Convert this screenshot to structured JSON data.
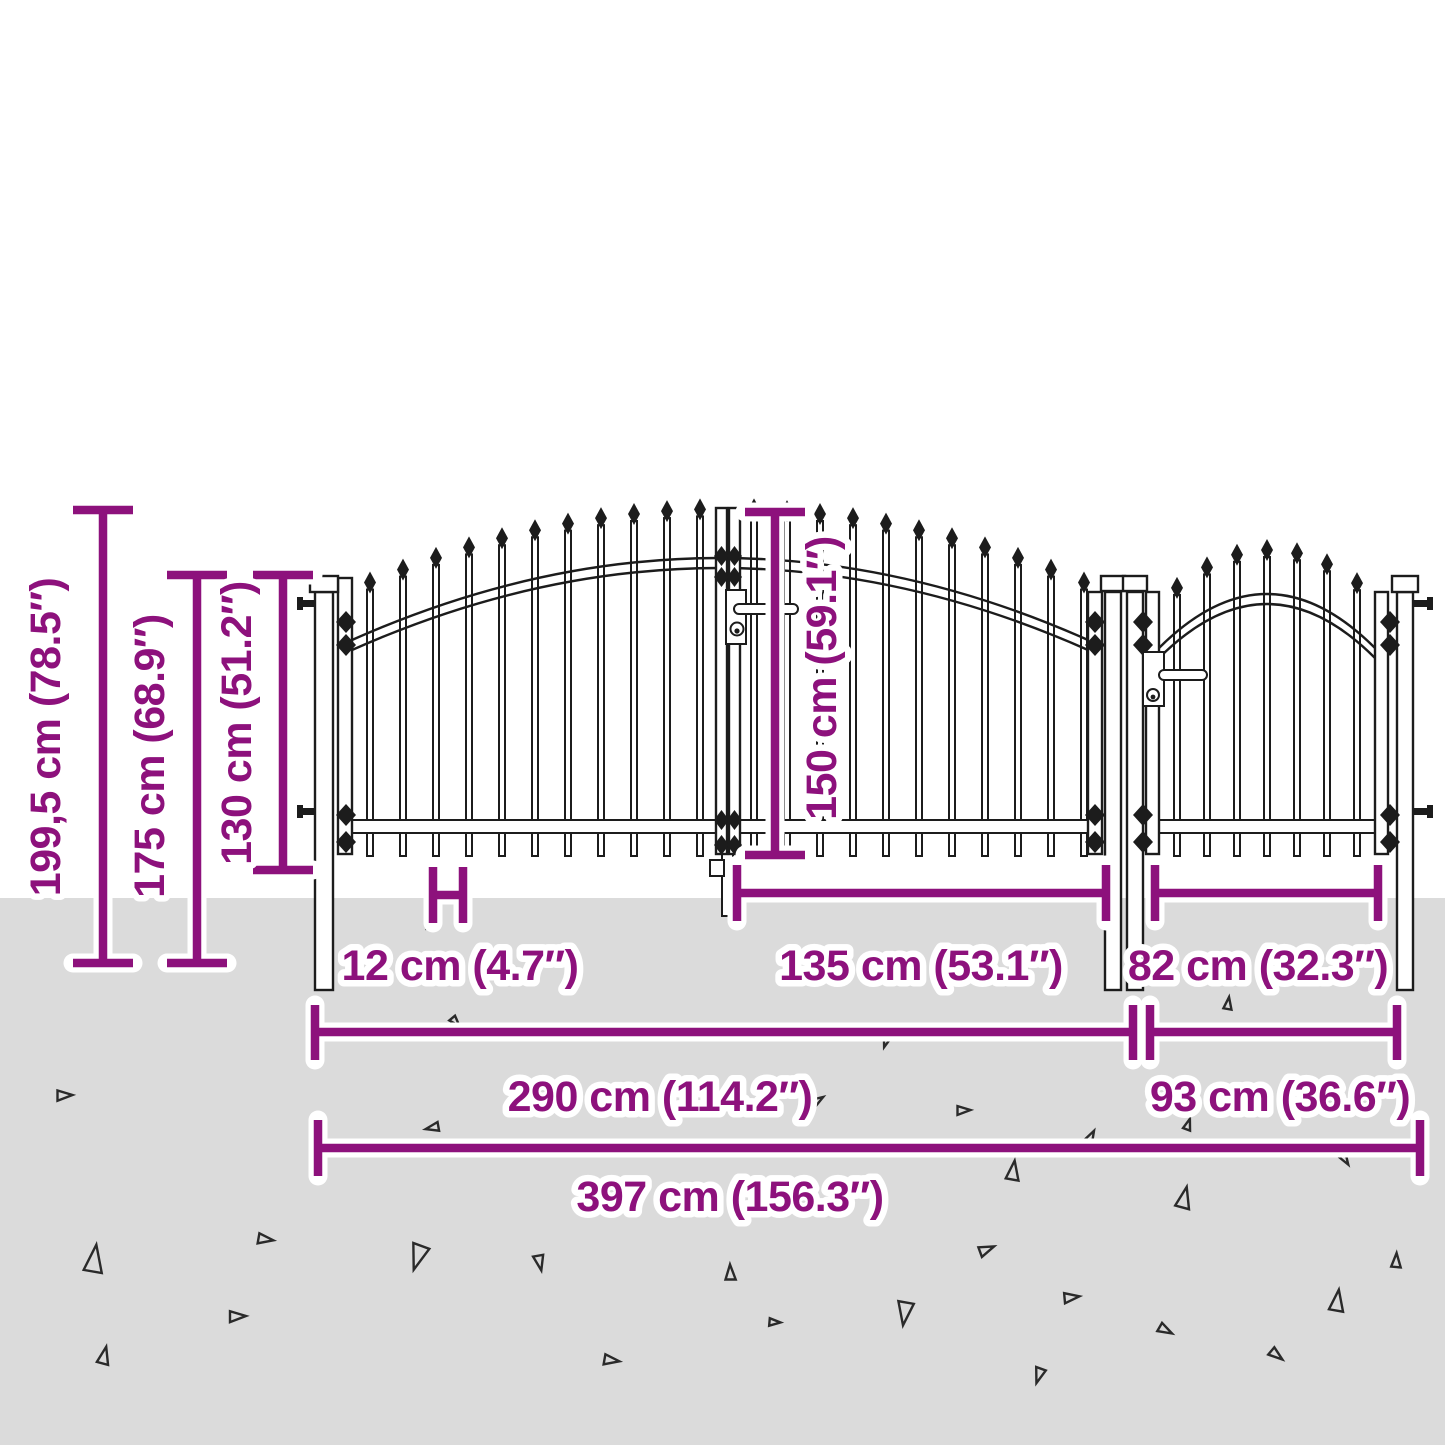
{
  "diagram": {
    "title": "Fence gate dimension diagram",
    "subject": "double garden gate with spear-top bars and single side gate",
    "colors": {
      "dimension_accent": "#8d117c",
      "ground": "#dbdbdb",
      "drawing_line": "#1c1c1c",
      "background": "#ffffff",
      "label_outline": "#ffffff"
    },
    "dimensions": {
      "vertical": [
        {
          "id": "total-height",
          "label": "199,5 cm (78.5″)"
        },
        {
          "id": "post-height",
          "label": "175 cm (68.9″)"
        },
        {
          "id": "height-above-ground",
          "label": "130 cm (51.2″)"
        },
        {
          "id": "gate-leaf-height",
          "label": "150 cm (59.1″)"
        }
      ],
      "horizontal": [
        {
          "id": "bar-spacing",
          "label": "12 cm (4.7″)"
        },
        {
          "id": "leaf-width",
          "label": "135 cm (53.1″)"
        },
        {
          "id": "small-gate-inner",
          "label": "82 cm (32.3″)"
        },
        {
          "id": "double-gate-width",
          "label": "290 cm (114.2″)"
        },
        {
          "id": "single-gate-width",
          "label": "93 cm (36.6″)"
        },
        {
          "id": "total-width",
          "label": "397 cm (156.3″)"
        }
      ]
    }
  }
}
